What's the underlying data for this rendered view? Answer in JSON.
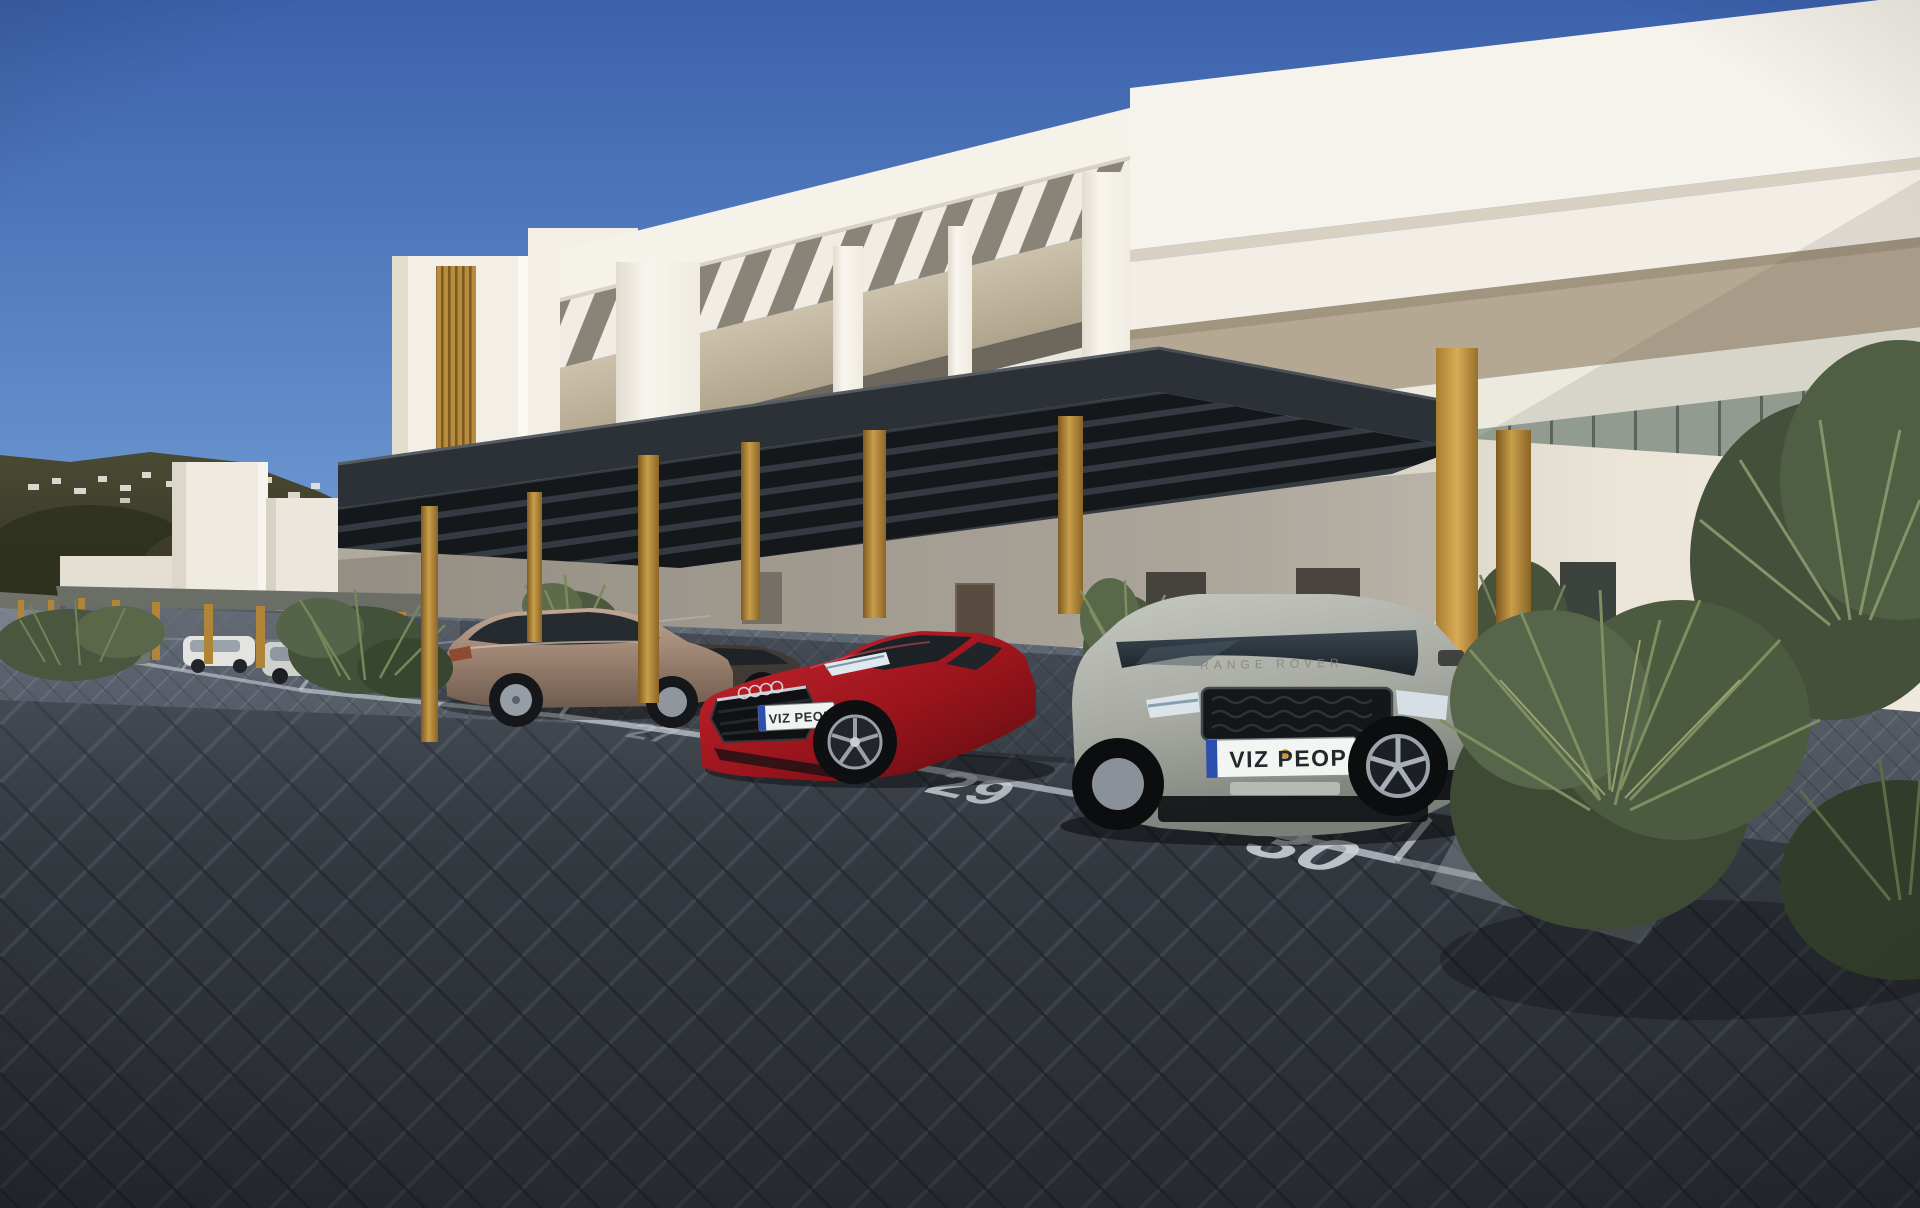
{
  "scene": {
    "type": "architectural-render",
    "description": "Modern white apartment residence with carport parking, four numbered bays, parked cars and landscaping under a clear blue sky",
    "sky": {
      "top_color": "#3b61ab",
      "horizon_color": "#7aa5d8"
    },
    "palette": {
      "facade_white": "#f5f2ea",
      "facade_shadow": "#d9d2c5",
      "balcony_beige": "#c2b7a0",
      "canopy_dark": "#2e3339",
      "wood_post": "#b3803a",
      "paver_dark": "#3f444c",
      "marking_white": "#ccd3da",
      "foliage_green": "#5c6b47",
      "hill_green": "#3a3d28"
    },
    "parking": {
      "spaces": [
        {
          "number": "27"
        },
        {
          "number": "28"
        },
        {
          "number": "29"
        },
        {
          "number": "30"
        }
      ]
    },
    "vehicles": [
      {
        "name": "bronze hatchback",
        "body_color": "#9b8271"
      },
      {
        "name": "dark sedan",
        "body_color": "#45403a"
      },
      {
        "name": "red coupe",
        "body_color": "#a0161e",
        "license_plate": "VIZ PEOP"
      },
      {
        "name": "silver suv",
        "body_color": "#a7aaa2",
        "license_plate": "VIZ PEOP",
        "hood_text": "RANGE ROVER"
      }
    ]
  }
}
